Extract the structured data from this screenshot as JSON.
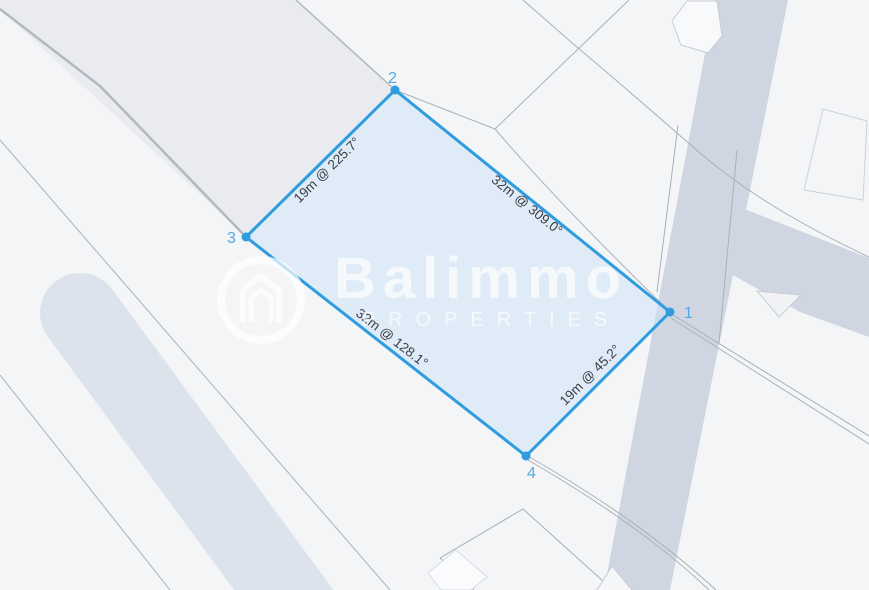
{
  "parcel": {
    "corners": [
      {
        "label": "1"
      },
      {
        "label": "2"
      },
      {
        "label": "3"
      },
      {
        "label": "4"
      }
    ],
    "edges": [
      {
        "from": "3",
        "to": "2",
        "length_m": 19,
        "bearing_deg": 225.7,
        "label": "19m @ 225.7°"
      },
      {
        "from": "2",
        "to": "1",
        "length_m": 32,
        "bearing_deg": 309.0,
        "label": "32m @ 309.0°"
      },
      {
        "from": "3",
        "to": "4",
        "length_m": 32,
        "bearing_deg": 128.1,
        "label": "32m @ 128.1°"
      },
      {
        "from": "4",
        "to": "1",
        "length_m": 19,
        "bearing_deg": 45.2,
        "label": "19m @ 45.2°"
      }
    ]
  },
  "watermark": {
    "brand": "Balimmo",
    "subtitle": "PROPERTIES"
  },
  "colors": {
    "background": "#f4f5f7",
    "block_fill": "#e9ebf0",
    "road_band": "#cfd6e2",
    "rounded_path": "#dde3ec",
    "parcel_fill": "#cee1f5",
    "parcel_border": "#2f9cdf",
    "corner_label": "#55a8e1",
    "edge_label_text": "#3a3f46",
    "watermark_white": "#ffffff"
  }
}
